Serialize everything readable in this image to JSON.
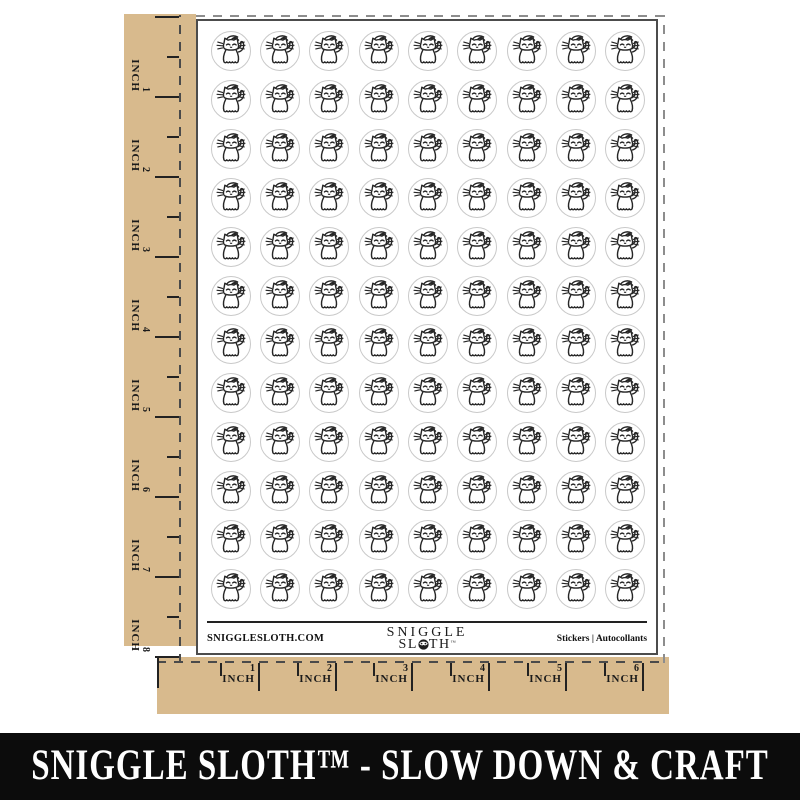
{
  "colors": {
    "kraft": "#d8ba8d",
    "ink": "#222222",
    "sticker_border": "#c9c9c9",
    "banner_bg": "#0c0c0c",
    "banner_fg": "#ffffff"
  },
  "sheet": {
    "rows": 12,
    "cols": 9,
    "sticker_design": "winking-cat",
    "footer": {
      "website": "SNIGGLESLOTH.COM",
      "logo_line1": "SNIGGLE",
      "logo_line2_pre": "SL",
      "logo_line2_post": "TH",
      "logo_tm": "™",
      "right_text": "Stickers  |  Autocollants"
    }
  },
  "rulers": {
    "unit": "INCH",
    "left_marks": [
      "1",
      "2",
      "3",
      "4",
      "5",
      "6",
      "7",
      "8"
    ],
    "bottom_marks": [
      "1",
      "2",
      "3",
      "4",
      "5",
      "6"
    ]
  },
  "banner": {
    "text": "SNIGGLE SLOTH™ - SLOW DOWN & CRAFT"
  }
}
